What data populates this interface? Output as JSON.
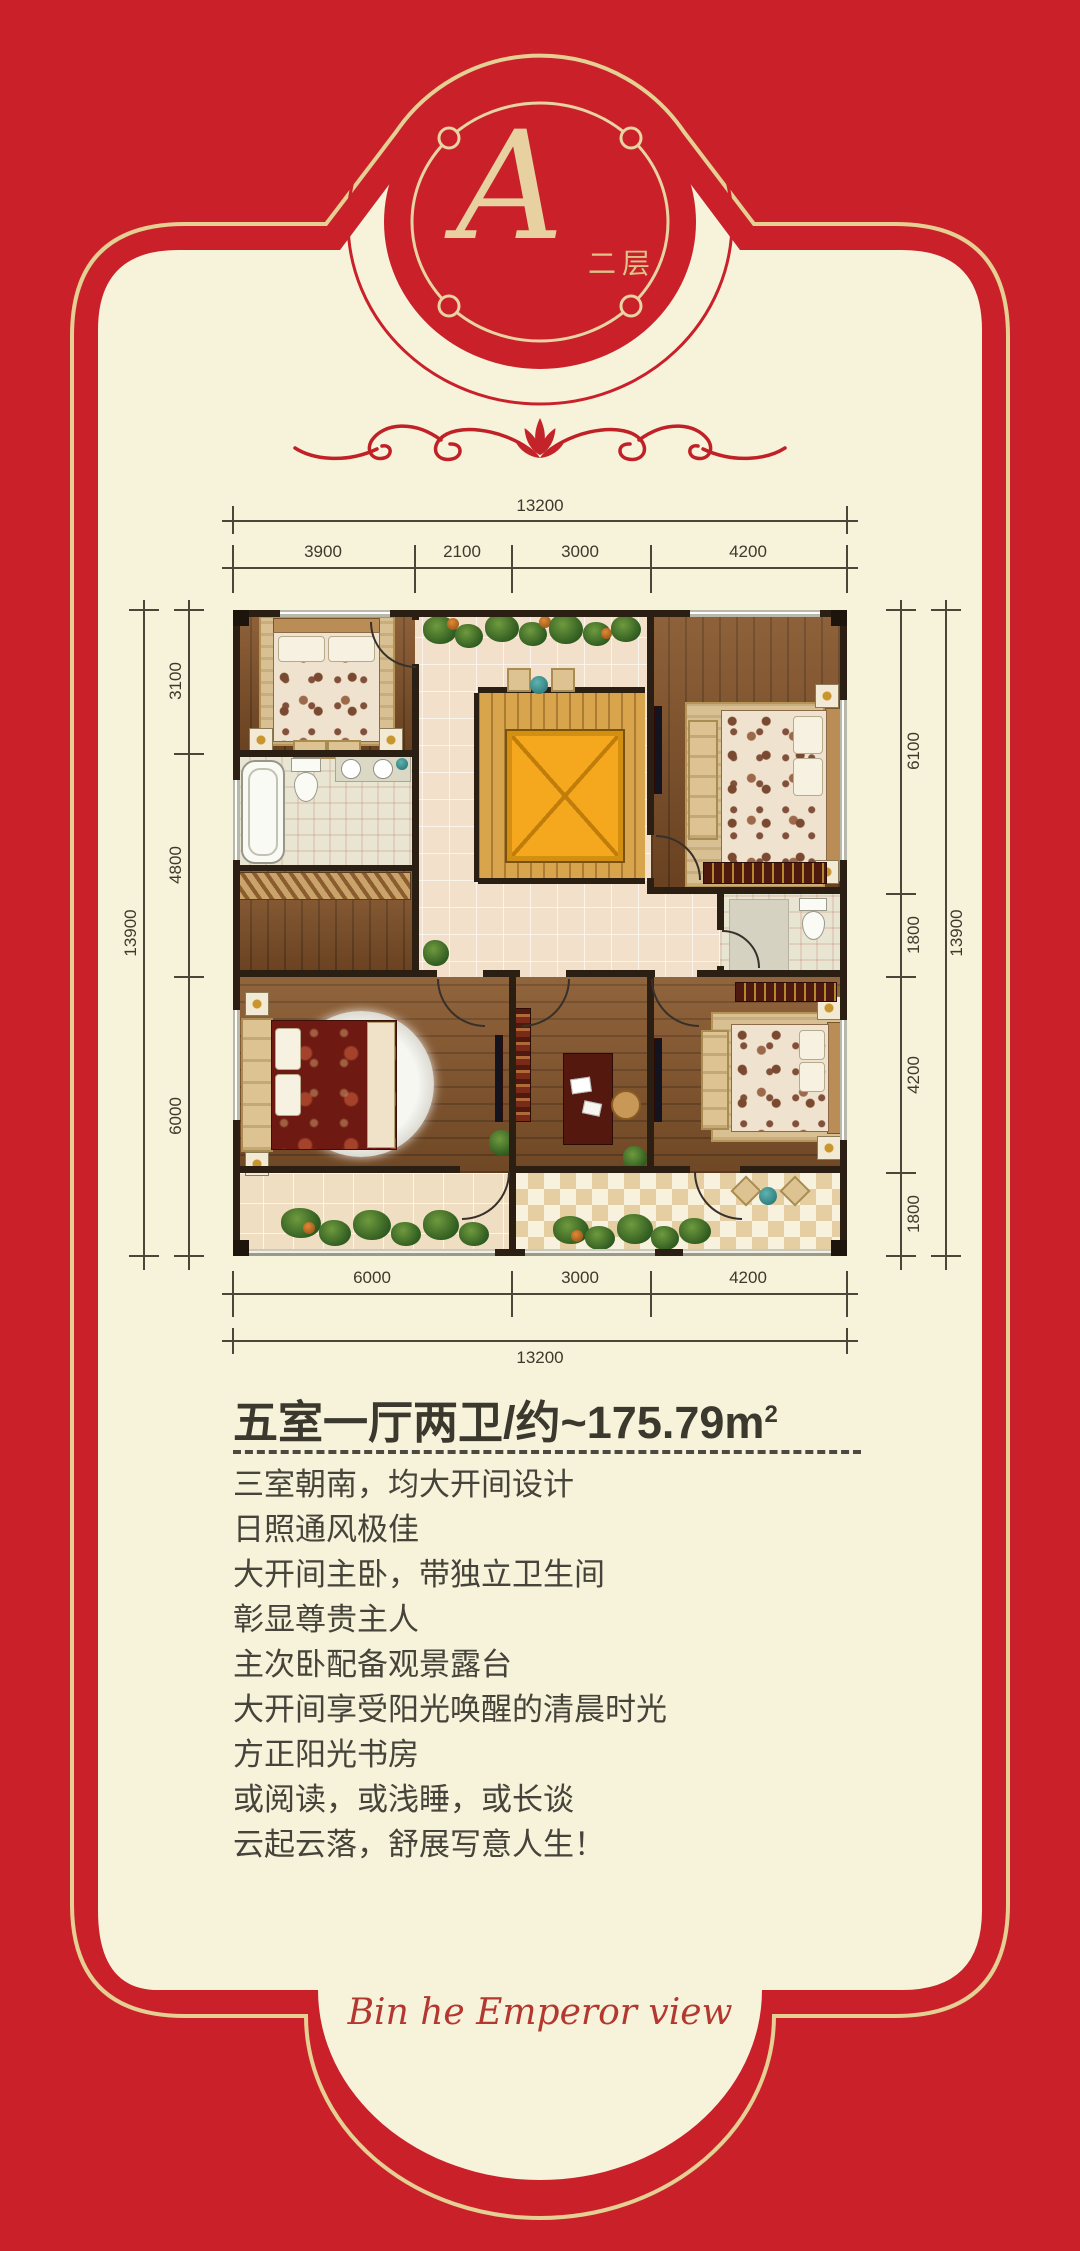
{
  "page": {
    "background_color": "#c9202a",
    "panel_color": "#f7f2da",
    "gold_line_color": "#e5cf93"
  },
  "badge": {
    "letter": "A",
    "floor_label": "二层"
  },
  "headline": {
    "title_main": "五室一厅两卫/约~175.79m",
    "title_sup": "2"
  },
  "description": {
    "lines": [
      "三室朝南，均大开间设计",
      "日照通风极佳",
      "大开间主卧，带独立卫生间",
      "彰显尊贵主人",
      "主次卧配备观景露台",
      "大开间享受阳光唤醒的清晨时光",
      "方正阳光书房",
      "或阅读，或浅睡，或长谈",
      "云起云落，舒展写意人生！"
    ]
  },
  "footer": {
    "script_text": "Bin he Emperor view"
  },
  "floor_plan": {
    "dimensions": {
      "top": {
        "overall": "13200",
        "segments": [
          "3900",
          "2100",
          "3000",
          "4200"
        ]
      },
      "bottom": {
        "overall": "13200",
        "segments": [
          "6000",
          "3000",
          "4200"
        ]
      },
      "left": {
        "overall": "13900",
        "segments": [
          "3100",
          "4800",
          "6000"
        ]
      },
      "right": {
        "overall": "13900",
        "segments": [
          "6100",
          "1800",
          "4200",
          "1800"
        ]
      }
    }
  }
}
